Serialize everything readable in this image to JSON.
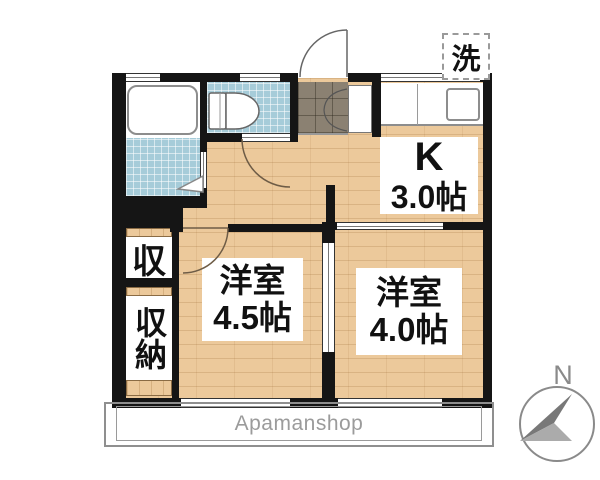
{
  "laundry_box": {
    "label": "洗"
  },
  "kitchen": {
    "label": "K",
    "area": "3.0帖"
  },
  "rooms": [
    {
      "label": "洋室",
      "area": "4.5帖"
    },
    {
      "label": "洋室",
      "area": "4.0帖"
    }
  ],
  "closets": [
    {
      "label": "収"
    },
    {
      "label": "収納"
    }
  ],
  "balcony": {
    "label": "Apamanshop"
  },
  "compass": {
    "north_label": "N"
  },
  "colors": {
    "wall": "#151515",
    "wood": "#ecc99b",
    "tile_blue": "#a6ccd9",
    "tile_entry": "#8b8172",
    "label_text": "#111111",
    "brand_gray": "#9b9b9b",
    "compass_gray": "#8a8a8a"
  }
}
